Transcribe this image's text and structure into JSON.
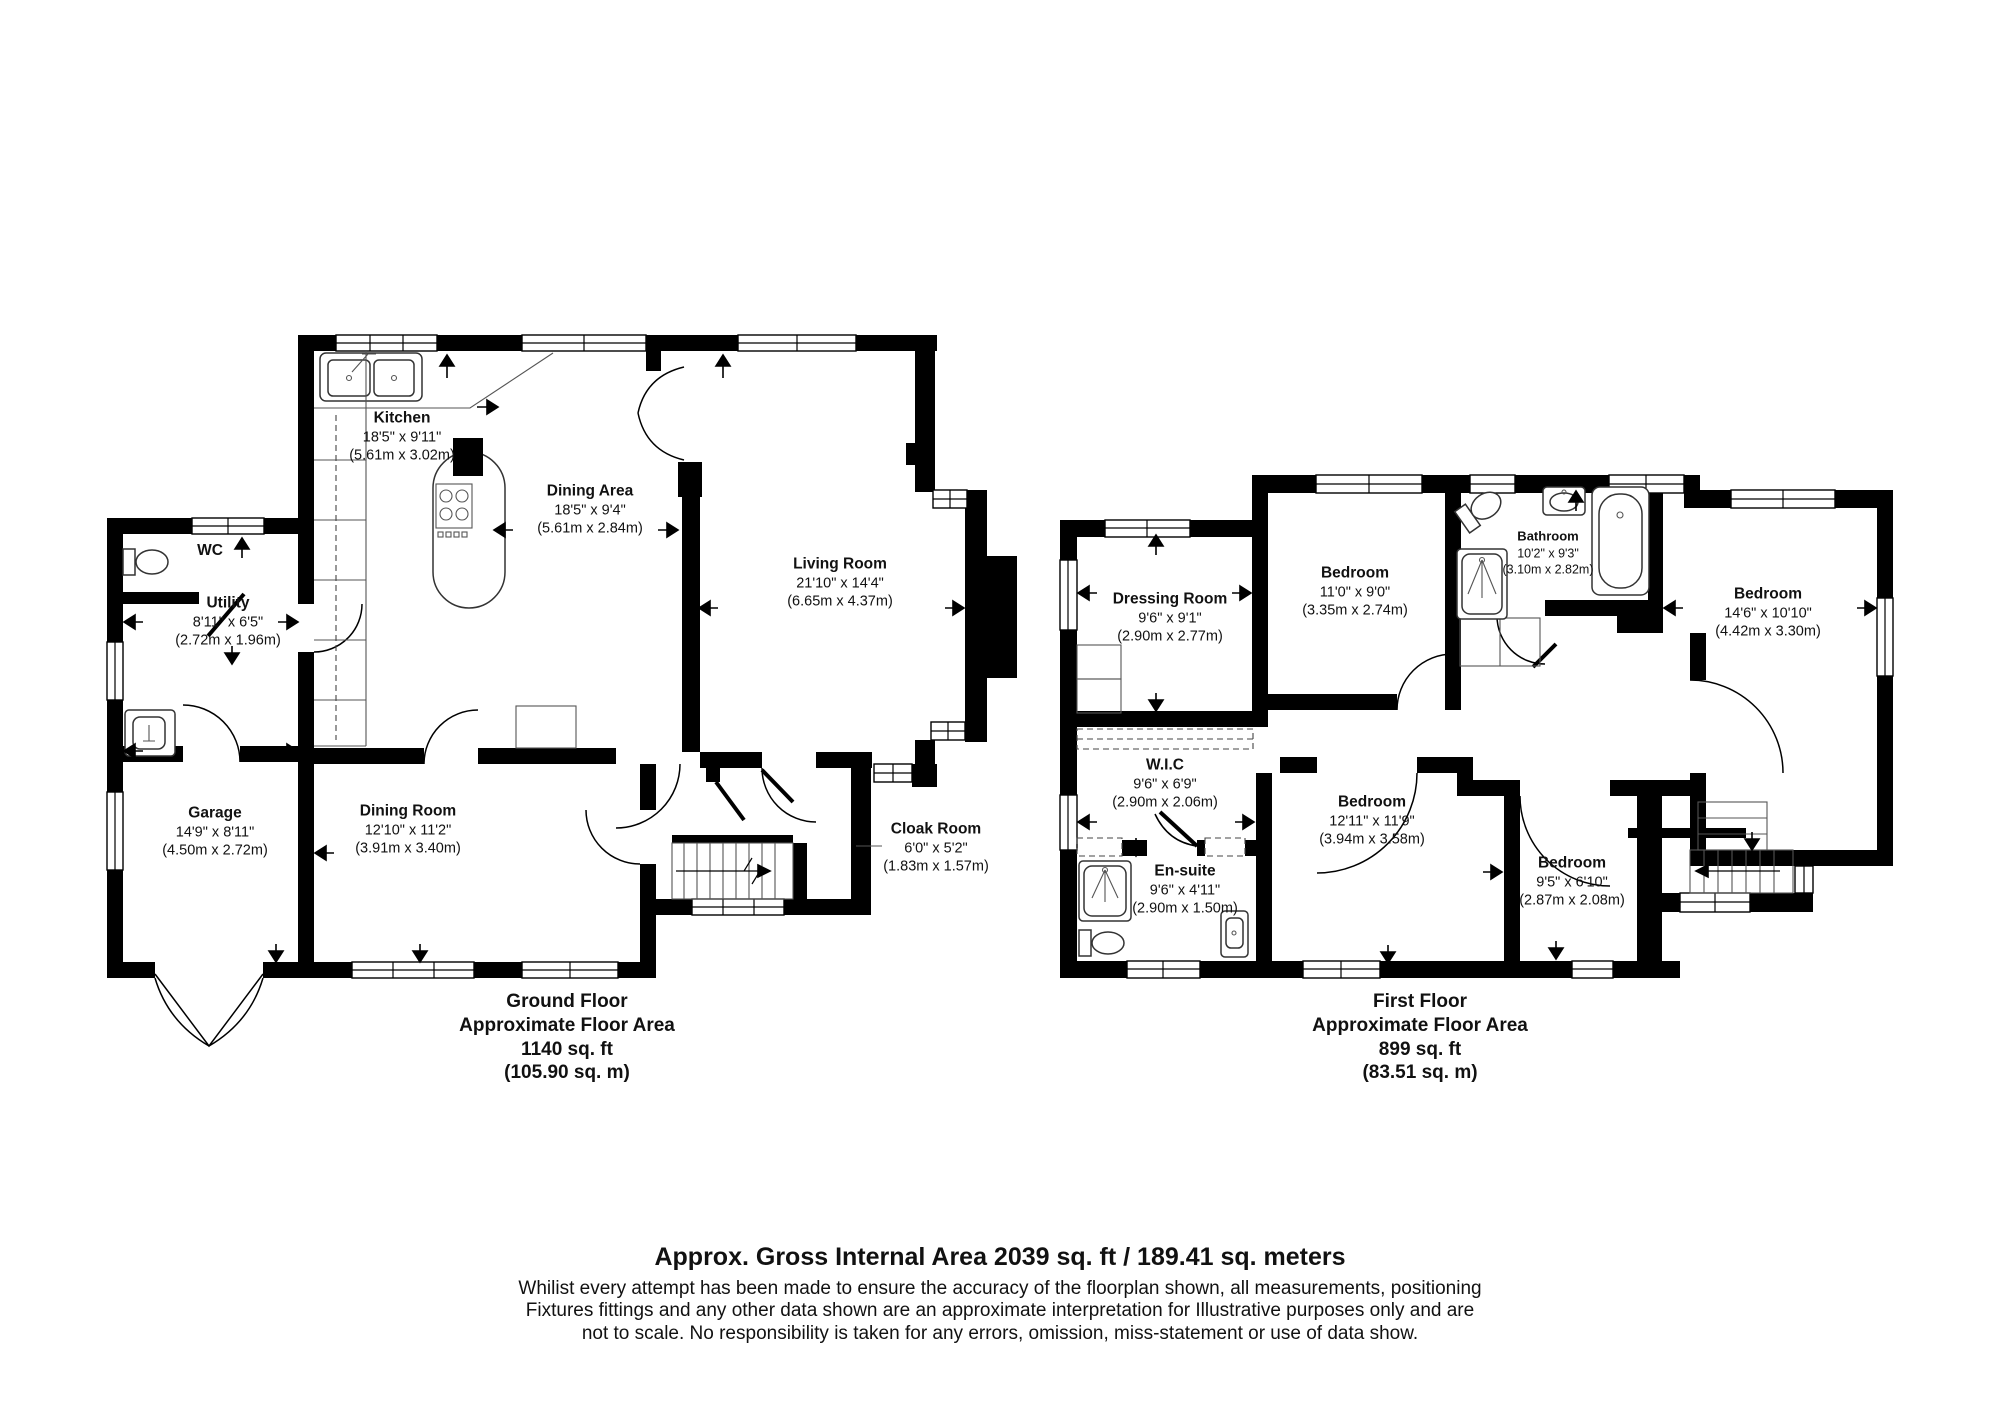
{
  "page": {
    "background": "#ffffff",
    "wall_color": "#000000",
    "text_color": "#111111"
  },
  "ground_floor": {
    "title": "Ground Floor",
    "subtitle": "Approximate Floor Area",
    "area_imperial": "1140 sq. ft",
    "area_metric": "(105.90 sq. m)",
    "rooms": {
      "kitchen": {
        "name": "Kitchen",
        "imperial": "18'5\" x 9'11\"",
        "metric": "(5.61m x 3.02m)"
      },
      "dining_area": {
        "name": "Dining Area",
        "imperial": "18'5\" x 9'4\"",
        "metric": "(5.61m x 2.84m)"
      },
      "living_room": {
        "name": "Living Room",
        "imperial": "21'10\" x 14'4\"",
        "metric": "(6.65m x 4.37m)"
      },
      "wc": {
        "name": "WC"
      },
      "utility": {
        "name": "Utility",
        "imperial": "8'11\" x 6'5\"",
        "metric": "(2.72m x 1.96m)"
      },
      "garage": {
        "name": "Garage",
        "imperial": "14'9\" x 8'11\"",
        "metric": "(4.50m x 2.72m)"
      },
      "dining_room": {
        "name": "Dining Room",
        "imperial": "12'10\" x 11'2\"",
        "metric": "(3.91m x 3.40m)"
      },
      "cloak_room": {
        "name": "Cloak Room",
        "imperial": "6'0\" x 5'2\"",
        "metric": "(1.83m x 1.57m)"
      }
    }
  },
  "first_floor": {
    "title": "First Floor",
    "subtitle": "Approximate Floor Area",
    "area_imperial": "899 sq. ft",
    "area_metric": "(83.51 sq. m)",
    "rooms": {
      "dressing_room": {
        "name": "Dressing Room",
        "imperial": "9'6\" x 9'1\"",
        "metric": "(2.90m x 2.77m)"
      },
      "bedroom_1": {
        "name": "Bedroom",
        "imperial": "11'0\" x 9'0\"",
        "metric": "(3.35m x 2.74m)"
      },
      "bathroom": {
        "name": "Bathroom",
        "imperial": "10'2\" x 9'3\"",
        "metric": "(3.10m x 2.82m)"
      },
      "bedroom_2": {
        "name": "Bedroom",
        "imperial": "14'6\" x 10'10\"",
        "metric": "(4.42m x 3.30m)"
      },
      "wic": {
        "name": "W.I.C",
        "imperial": "9'6\" x 6'9\"",
        "metric": "(2.90m x 2.06m)"
      },
      "bedroom_3": {
        "name": "Bedroom",
        "imperial": "12'11\" x 11'9\"",
        "metric": "(3.94m x 3.58m)"
      },
      "en_suite": {
        "name": "En-suite",
        "imperial": "9'6\" x 4'11\"",
        "metric": "(2.90m x 1.50m)"
      },
      "bedroom_4": {
        "name": "Bedroom",
        "imperial": "9'5\" x 6'10\"",
        "metric": "(2.87m x 2.08m)"
      }
    }
  },
  "footer": {
    "headline": "Approx. Gross Internal Area 2039 sq. ft / 189.41 sq. meters",
    "disclaimer_line1": "Whilist every attempt has been made to ensure the accuracy of the floorplan shown, all measurements, positioning",
    "disclaimer_line2": "Fixtures fittings and any other data shown are an approximate interpretation for Illustrative purposes only  and are",
    "disclaimer_line3": "not to scale. No responsibility is taken for any errors, omission, miss-statement or use of data show."
  }
}
